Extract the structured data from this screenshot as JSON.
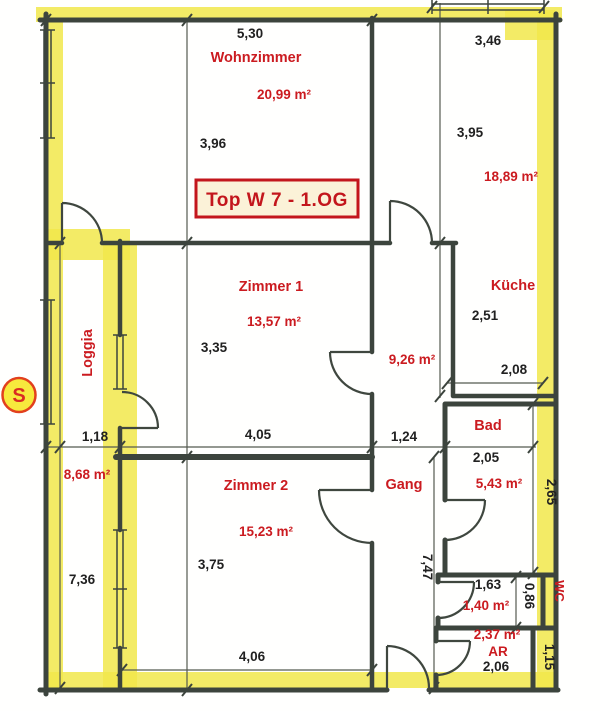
{
  "title": {
    "text": "Top W 7 - 1.OG"
  },
  "compass": {
    "label": "S"
  },
  "colors": {
    "label_red": "#cb1b20",
    "dimension_black": "#212121",
    "highlight_yellow": "#f1e84b",
    "wall_gray": "#3c443d",
    "title_box_bg": "#fbf2d8"
  },
  "rooms": {
    "wohnzimmer": {
      "name": "Wohnzimmer",
      "area": "20,99 m²",
      "width": "5,30",
      "depth": "3,96"
    },
    "kueche": {
      "name": "Küche",
      "area": "18,89 m²",
      "window_width": "3,46",
      "depth": "3,95",
      "lower_depth": "2,51",
      "lower_width": "2,08"
    },
    "zimmer1": {
      "name": "Zimmer 1",
      "area": "13,57 m²",
      "width": "4,05",
      "depth": "3,35"
    },
    "zimmer2": {
      "name": "Zimmer 2",
      "area": "15,23 m²",
      "width": "4,06",
      "depth": "3,75"
    },
    "loggia": {
      "name": "Loggia",
      "area": "8,68 m²",
      "width": "1,18",
      "length": "7,36"
    },
    "gang": {
      "name": "Gang",
      "area": "9,26 m²",
      "width": "1,24",
      "length": "7,47"
    },
    "bad": {
      "name": "Bad",
      "area": "5,43 m²",
      "width": "2,05",
      "depth": "2,65"
    },
    "wc": {
      "name": "WC",
      "area": "1,40 m²",
      "width": "1,63",
      "depth": "0,86"
    },
    "ar": {
      "name": "AR",
      "area": "2,37 m²",
      "width": "2,06",
      "depth": "1,15"
    }
  }
}
